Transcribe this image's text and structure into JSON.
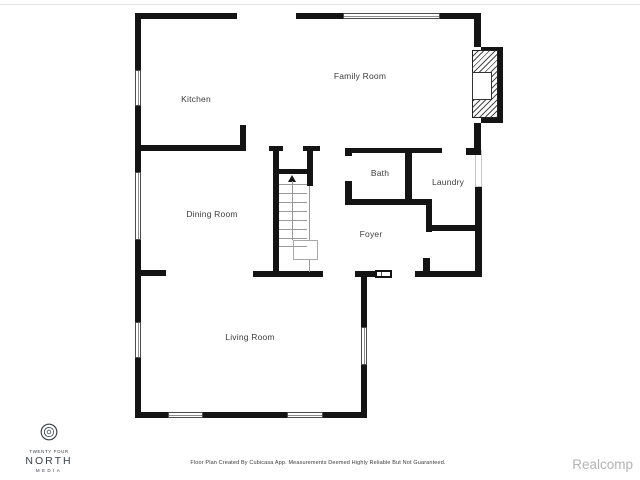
{
  "floorplan": {
    "rooms": [
      {
        "name": "Kitchen"
      },
      {
        "name": "Family Room"
      },
      {
        "name": "Bath"
      },
      {
        "name": "Laundry"
      },
      {
        "name": "Dining Room"
      },
      {
        "name": "Foyer"
      },
      {
        "name": "Living Room"
      }
    ],
    "icons": {
      "stairs": "up-arrow-icon",
      "logo": "aperture-swirl-icon"
    },
    "colors": {
      "wall": "#141414",
      "label": "#3c3c3c"
    }
  },
  "branding": {
    "line1": "TWENTY FOUR",
    "line2": "NORTH",
    "line3": "MEDIA",
    "color": "#3b4149"
  },
  "footer": {
    "disclaimer": "Floor Plan Created By Cubicasa App. Measurements Deemed Highly Reliable But Not Guaranteed."
  },
  "watermark": {
    "text": "Realcomp",
    "color": "#b3b3b3"
  }
}
